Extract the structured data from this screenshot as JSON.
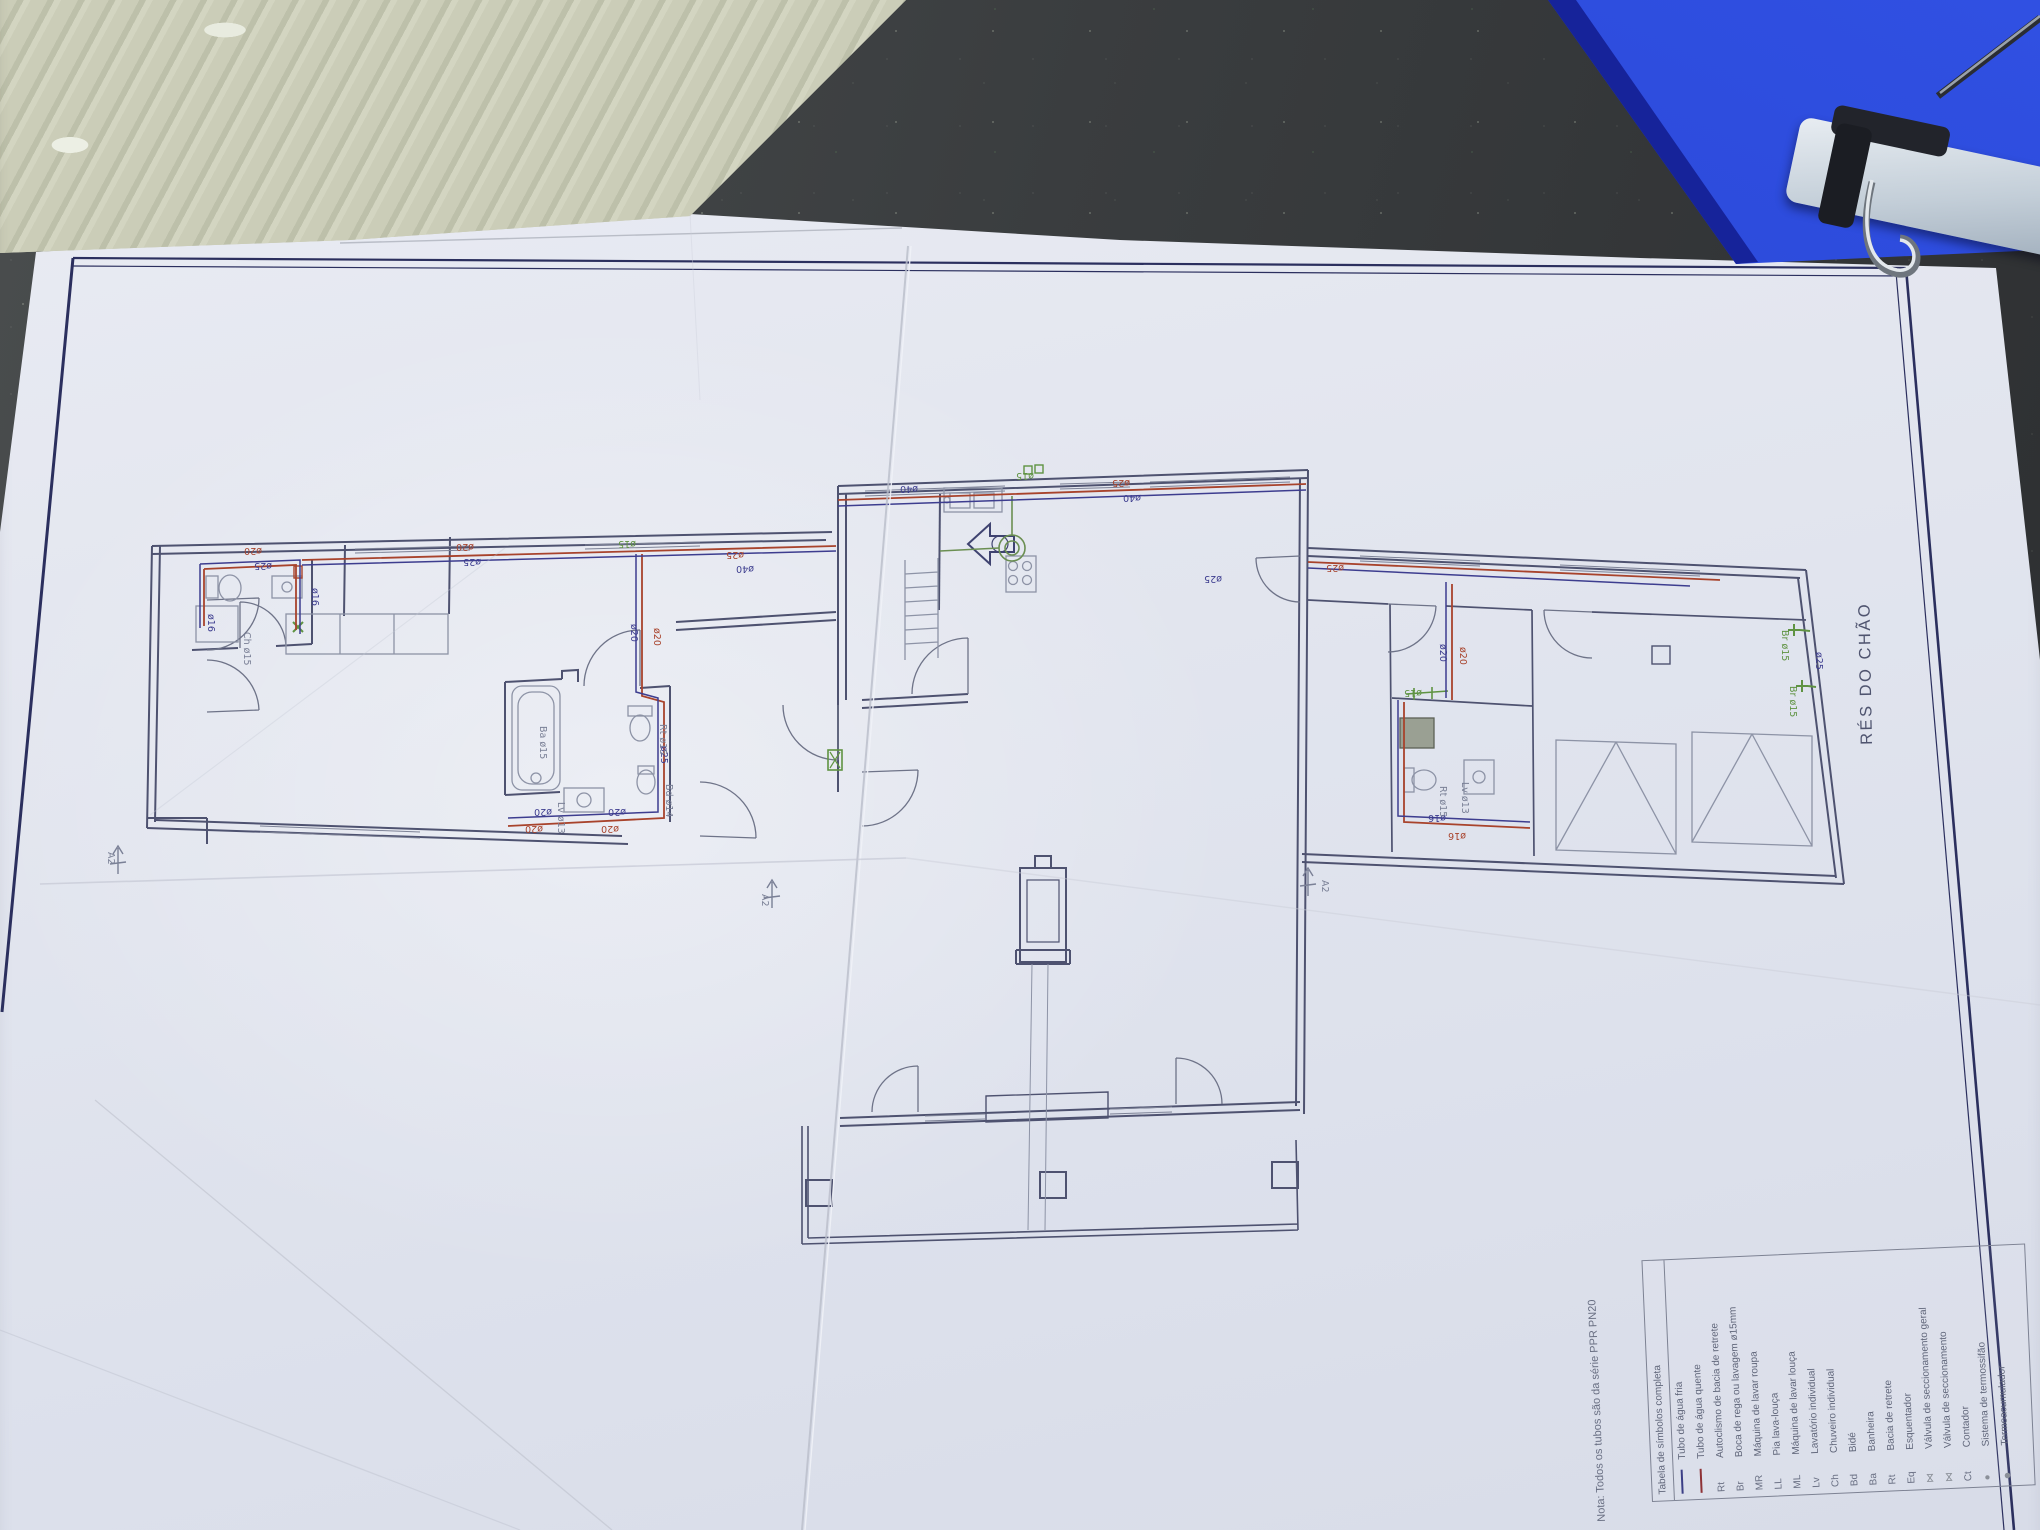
{
  "scene": {
    "description": "photo of a plumbing floor-plan sheet on a dark table",
    "objects": [
      "corrugated-cardboard",
      "blue-clipboard",
      "paper-sheet"
    ],
    "colors": {
      "table": "#3a3d3f",
      "cardboard": "#c6c8b3",
      "folder_blue": "#2743d2",
      "paper": "#e3e6ef",
      "wall_line": "#4e5270",
      "border_navy": "#2b2f5e",
      "pipe_hot": "#a8432c",
      "pipe_cold": "#3d3d8f",
      "fixture_green": "#5f9342"
    }
  },
  "sheet": {
    "title": "RÉS DO CHÃO",
    "note": "Nota: Todos os tubos são da série PPR PN20",
    "legend": {
      "header": "Tabela de símbolos completa",
      "items": [
        {
          "sym": "line-cold",
          "abbr": "",
          "label": "Tubo de água fria"
        },
        {
          "sym": "line-hot",
          "abbr": "",
          "label": "Tubo de água quente"
        },
        {
          "sym": "",
          "abbr": "Rt",
          "label": "Autoclismo de bacia de retrete"
        },
        {
          "sym": "",
          "abbr": "Br",
          "label": "Boca de rega ou lavagem ø15mm"
        },
        {
          "sym": "",
          "abbr": "MR",
          "label": "Máquina de lavar roupa"
        },
        {
          "sym": "",
          "abbr": "LL",
          "label": "Pia lava-louça"
        },
        {
          "sym": "",
          "abbr": "ML",
          "label": "Máquina de lavar louça"
        },
        {
          "sym": "",
          "abbr": "Lv",
          "label": "Lavatório individual"
        },
        {
          "sym": "",
          "abbr": "Ch",
          "label": "Chuveiro individual"
        },
        {
          "sym": "",
          "abbr": "Bd",
          "label": "Bidé"
        },
        {
          "sym": "",
          "abbr": "Ba",
          "label": "Banheira"
        },
        {
          "sym": "",
          "abbr": "Rt",
          "label": "Bacia de retrete"
        },
        {
          "sym": "",
          "abbr": "Eq",
          "label": "Esquentador"
        },
        {
          "sym": "valve",
          "abbr": "",
          "label": "Válvula de seccionamento geral"
        },
        {
          "sym": "valve",
          "abbr": "",
          "label": "Válvula de seccionamento"
        },
        {
          "sym": "",
          "abbr": "Ct",
          "label": "Contador"
        },
        {
          "sym": "dot",
          "abbr": "",
          "label": "Sistema de termossifão"
        },
        {
          "sym": "dot2",
          "abbr": "",
          "label": "Termoacumulador"
        }
      ]
    }
  },
  "plan": {
    "labels": [
      {
        "t": "ø20",
        "x": 474,
        "y": 544,
        "r": 180,
        "c": "hot"
      },
      {
        "t": "ø25",
        "x": 481,
        "y": 559,
        "r": 180,
        "c": "cold"
      },
      {
        "t": "ø15",
        "x": 636,
        "y": 541,
        "r": 180,
        "c": "green"
      },
      {
        "t": "ø25",
        "x": 744,
        "y": 552,
        "r": 180,
        "c": "hot"
      },
      {
        "t": "ø40",
        "x": 754,
        "y": 566,
        "r": 180,
        "c": "cold"
      },
      {
        "t": "ø40",
        "x": 918,
        "y": 486,
        "r": 180,
        "c": "cold"
      },
      {
        "t": "ø15",
        "x": 1034,
        "y": 473,
        "r": 180,
        "c": "green"
      },
      {
        "t": "ø25",
        "x": 1130,
        "y": 480,
        "r": 180,
        "c": "hot"
      },
      {
        "t": "ø40",
        "x": 1141,
        "y": 495,
        "r": 180,
        "c": "cold"
      },
      {
        "t": "ø20",
        "x": 631,
        "y": 624,
        "r": 90,
        "c": "cold"
      },
      {
        "t": "ø20",
        "x": 654,
        "y": 628,
        "r": 90,
        "c": "hot"
      },
      {
        "t": "ø20",
        "x": 552,
        "y": 809,
        "r": 180,
        "c": "cold"
      },
      {
        "t": "ø20",
        "x": 543,
        "y": 826,
        "r": 180,
        "c": "hot"
      },
      {
        "t": "ø20",
        "x": 626,
        "y": 809,
        "r": 180,
        "c": "cold"
      },
      {
        "t": "ø20",
        "x": 619,
        "y": 826,
        "r": 180,
        "c": "hot"
      },
      {
        "t": "ø25",
        "x": 661,
        "y": 746,
        "r": 90,
        "c": "cold"
      },
      {
        "t": "ø16",
        "x": 208,
        "y": 614,
        "r": 90,
        "c": "cold"
      },
      {
        "t": "ø16",
        "x": 312,
        "y": 588,
        "r": 90,
        "c": "cold"
      },
      {
        "t": "ø20",
        "x": 262,
        "y": 548,
        "r": 180,
        "c": "hot"
      },
      {
        "t": "ø25",
        "x": 272,
        "y": 563,
        "r": 180,
        "c": "cold"
      },
      {
        "t": "ø16",
        "x": 1446,
        "y": 815,
        "r": 180,
        "c": "cold"
      },
      {
        "t": "ø16",
        "x": 1466,
        "y": 833,
        "r": 180,
        "c": "hot"
      },
      {
        "t": "ø25",
        "x": 1816,
        "y": 652,
        "r": 90,
        "c": "cold"
      },
      {
        "t": "Br ø15",
        "x": 1782,
        "y": 630,
        "r": 90,
        "c": "green"
      },
      {
        "t": "Br ø15",
        "x": 1790,
        "y": 686,
        "r": 90,
        "c": "green"
      },
      {
        "t": "ø20",
        "x": 1440,
        "y": 644,
        "r": 90,
        "c": "cold"
      },
      {
        "t": "ø20",
        "x": 1460,
        "y": 647,
        "r": 90,
        "c": "hot"
      },
      {
        "t": "ø25",
        "x": 1344,
        "y": 565,
        "r": 180,
        "c": "hot"
      },
      {
        "t": "ø25",
        "x": 1222,
        "y": 576,
        "r": 180,
        "c": "cold"
      },
      {
        "t": "ø15",
        "x": 1422,
        "y": 690,
        "r": 180,
        "c": "green"
      },
      {
        "t": "A2",
        "x": 108,
        "y": 852,
        "r": 90,
        "c": "grey"
      },
      {
        "t": "A2",
        "x": 762,
        "y": 894,
        "r": 90,
        "c": "grey"
      },
      {
        "t": "A2",
        "x": 1322,
        "y": 880,
        "r": 90,
        "c": "grey"
      },
      {
        "t": "Ba ø15",
        "x": 540,
        "y": 726,
        "r": 90,
        "c": "grey"
      },
      {
        "t": "Rt ø15",
        "x": 660,
        "y": 724,
        "r": 90,
        "c": "grey"
      },
      {
        "t": "Bd ø14",
        "x": 666,
        "y": 784,
        "r": 90,
        "c": "grey"
      },
      {
        "t": "Lv ø13",
        "x": 558,
        "y": 802,
        "r": 90,
        "c": "grey"
      },
      {
        "t": "Rt ø15",
        "x": 1440,
        "y": 786,
        "r": 90,
        "c": "grey"
      },
      {
        "t": "Lv ø13",
        "x": 1462,
        "y": 782,
        "r": 90,
        "c": "grey"
      },
      {
        "t": "Ch ø15",
        "x": 244,
        "y": 632,
        "r": 90,
        "c": "grey"
      }
    ]
  }
}
